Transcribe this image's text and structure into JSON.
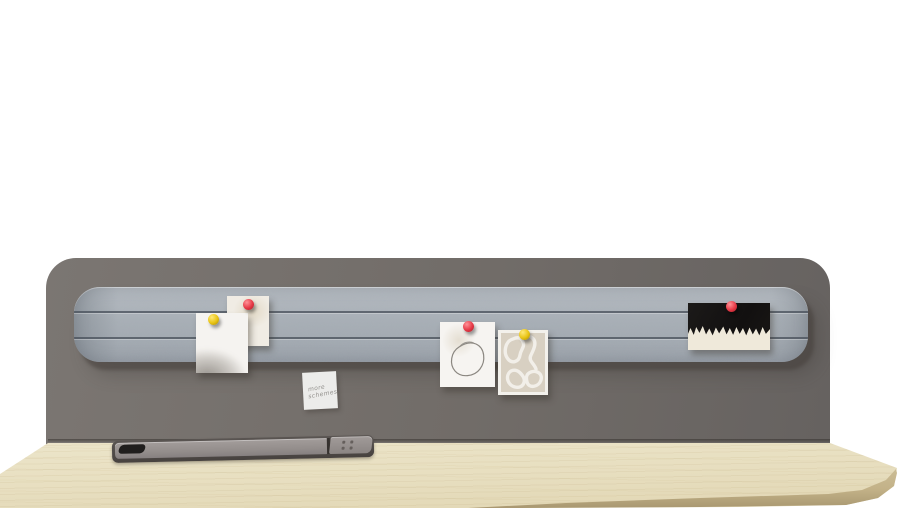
{
  "scene": {
    "kind": "product photograph",
    "subject": "desk with felt pinboard privacy panel",
    "background_color": "#ffffff"
  },
  "panel": {
    "label": "privacy-panel",
    "color": "#716c68"
  },
  "pinboard": {
    "label": "felt-pinboard-strip",
    "color": "#a9b0b7",
    "groove_count": 2
  },
  "desk": {
    "surface_color": "#e8dfc3",
    "edge_color": "#c9ba92"
  },
  "cable_tray": {
    "lid_color": "#948e8c",
    "slot_color": "#201e1d",
    "socket_count": 4
  },
  "sticky_note": {
    "line1": "more",
    "line2": "schemes",
    "paper_color": "#ececea"
  },
  "pins": [
    {
      "id": "pin-1",
      "color_name": "red",
      "hex": "#e63946",
      "on": "photo card"
    },
    {
      "id": "pin-2",
      "color_name": "yellow",
      "hex": "#e8c313",
      "on": "watercolor card"
    },
    {
      "id": "pin-3",
      "color_name": "red",
      "hex": "#e63946",
      "on": "circle sketch card"
    },
    {
      "id": "pin-4",
      "color_name": "yellow",
      "hex": "#e8c313",
      "on": "line art card"
    },
    {
      "id": "pin-5",
      "color_name": "red",
      "hex": "#e63946",
      "on": "black painting card"
    }
  ],
  "pinned_items": [
    {
      "name": "photo card",
      "desc": "cream card with faint pattern"
    },
    {
      "name": "watercolor card",
      "desc": "white card with gray wash at bottom"
    },
    {
      "name": "circle sketch card",
      "desc": "white card with hand-drawn circle"
    },
    {
      "name": "line art card",
      "desc": "beige card with white abstract line art"
    },
    {
      "name": "black painting card",
      "desc": "black card with torn white paint strip"
    },
    {
      "name": "sticky note",
      "desc": "handwritten note"
    }
  ]
}
